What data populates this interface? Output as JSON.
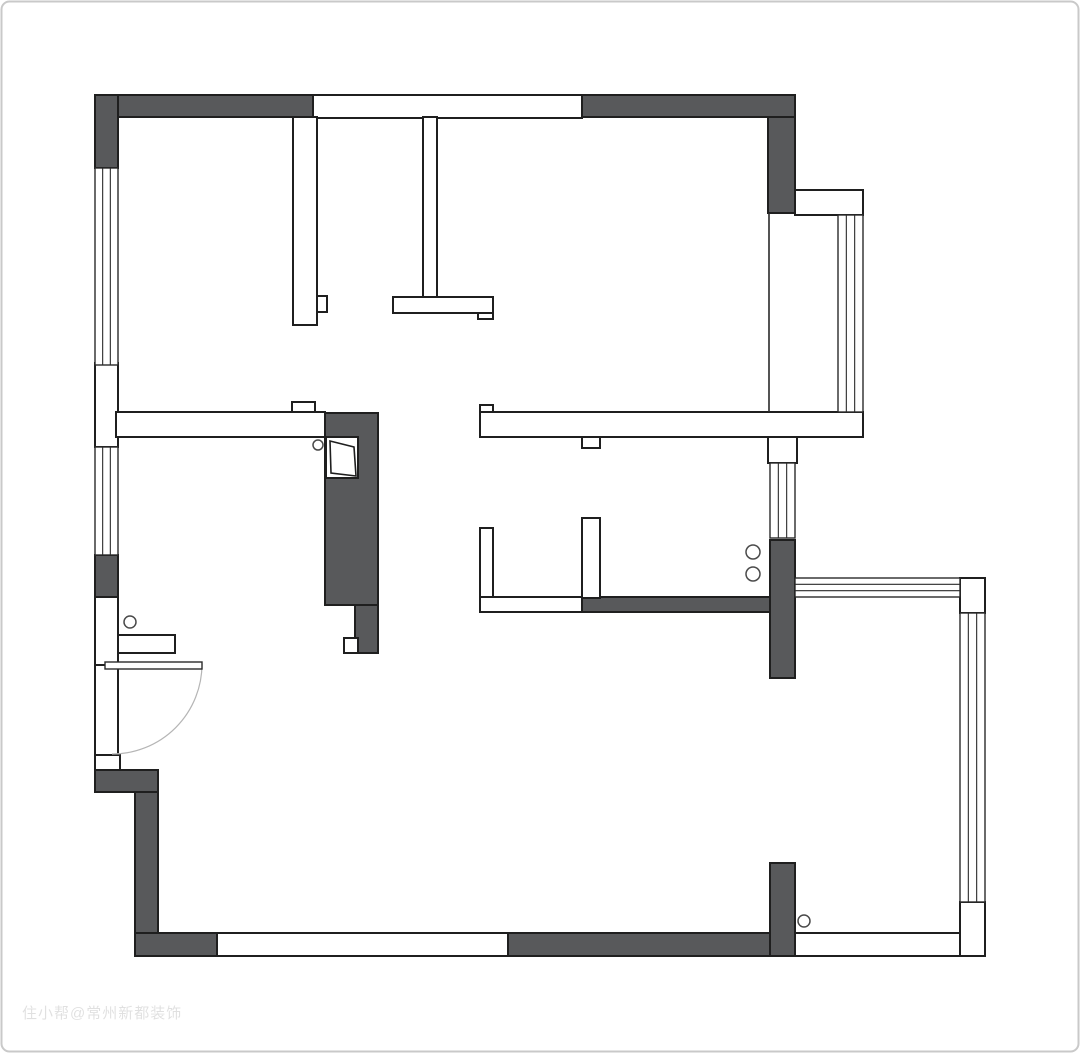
{
  "canvas": {
    "width": 1080,
    "height": 1053,
    "background": "#ffffff",
    "border_color": "#c9c9c9",
    "border_radius": 8
  },
  "palette": {
    "dark_wall_fill": "#58595B",
    "outline": "#1f1f1f",
    "thin_line": "#2a2a2a",
    "arc_color": "#b5b5b5",
    "circle_stroke": "#4a4a4a",
    "watermark_color": "rgba(0,0,0,0.12)"
  },
  "watermark": {
    "text": "住小帮@常州新都装饰",
    "x": 22,
    "y": 1018,
    "font_size": 15
  },
  "plan": {
    "dark_walls": [
      [
        95,
        95,
        218,
        22
      ],
      [
        95,
        95,
        23,
        73
      ],
      [
        582,
        95,
        213,
        22
      ],
      [
        768,
        117,
        27,
        96
      ],
      [
        95,
        555,
        23,
        42
      ],
      [
        95,
        770,
        63,
        22
      ],
      [
        135,
        792,
        23,
        164
      ],
      [
        135,
        933,
        82,
        23
      ],
      [
        508,
        933,
        262,
        23
      ],
      [
        770,
        863,
        25,
        93
      ],
      [
        325,
        413,
        53,
        192
      ],
      [
        355,
        605,
        23,
        48
      ],
      [
        770,
        540,
        25,
        138
      ],
      [
        582,
        597,
        188,
        15
      ]
    ],
    "light_walls": [
      [
        313,
        95,
        269,
        23
      ],
      [
        293,
        117,
        24,
        208
      ],
      [
        317,
        296,
        10,
        16
      ],
      [
        423,
        117,
        14,
        180
      ],
      [
        393,
        297,
        100,
        16
      ],
      [
        478,
        313,
        15,
        6
      ],
      [
        95,
        363,
        23,
        84
      ],
      [
        116,
        412,
        209,
        25
      ],
      [
        292,
        402,
        23,
        10
      ],
      [
        480,
        412,
        383,
        25
      ],
      [
        480,
        405,
        13,
        7
      ],
      [
        582,
        437,
        18,
        11
      ],
      [
        95,
        597,
        23,
        68
      ],
      [
        95,
        665,
        23,
        90
      ],
      [
        118,
        635,
        57,
        18
      ],
      [
        95,
        755,
        25,
        15
      ],
      [
        217,
        933,
        291,
        23
      ],
      [
        795,
        933,
        190,
        23
      ],
      [
        960,
        902,
        25,
        54
      ],
      [
        960,
        578,
        25,
        35
      ],
      [
        795,
        190,
        68,
        25
      ],
      [
        768,
        437,
        29,
        26
      ],
      [
        480,
        528,
        13,
        84
      ],
      [
        582,
        518,
        18,
        80
      ],
      [
        480,
        597,
        102,
        15
      ],
      [
        326,
        437,
        32,
        41
      ],
      [
        344,
        638,
        14,
        15
      ]
    ],
    "windows": [
      {
        "rect": [
          95,
          168,
          23,
          197
        ],
        "dir": "v"
      },
      {
        "rect": [
          95,
          447,
          23,
          108
        ],
        "dir": "v"
      },
      {
        "rect": [
          770,
          463,
          25,
          75
        ],
        "dir": "v"
      },
      {
        "rect": [
          838,
          215,
          25,
          197
        ],
        "dir": "v"
      },
      {
        "rect": [
          795,
          578,
          165,
          19
        ],
        "dir": "h"
      },
      {
        "rect": [
          960,
          613,
          25,
          289
        ],
        "dir": "v"
      }
    ],
    "edge_lines": [
      [
        769,
        213,
        769,
        412
      ]
    ],
    "door": {
      "leaf": [
        105,
        662,
        97,
        7
      ],
      "arc": "M 202 664 A 90 90 0 0 1 112 754"
    },
    "flue_glyph": "330,441 354,447 356,476 331,473",
    "circles": [
      [
        130,
        622,
        6
      ],
      [
        318,
        445,
        5
      ],
      [
        753,
        552,
        7
      ],
      [
        753,
        574,
        7
      ],
      [
        804,
        921,
        6
      ]
    ]
  }
}
